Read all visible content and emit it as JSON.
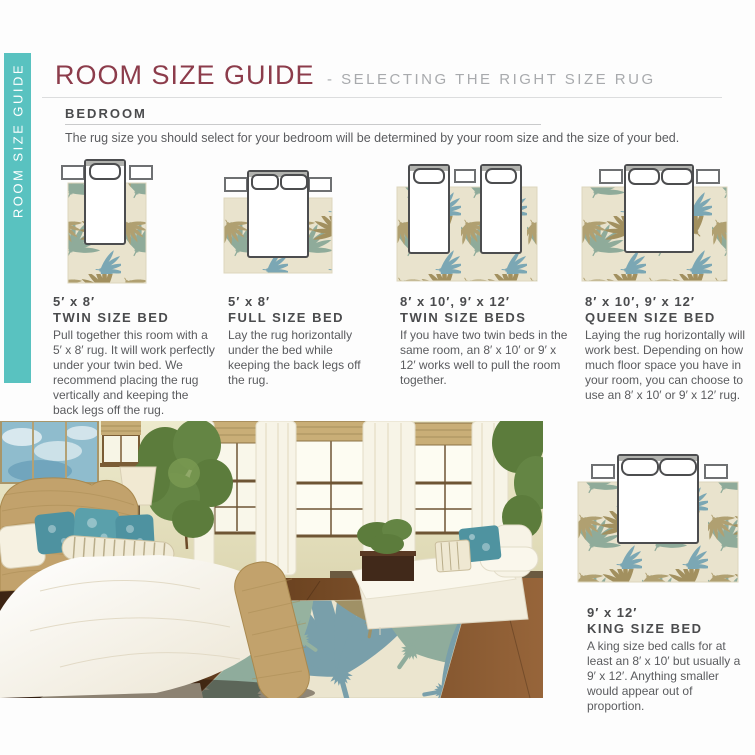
{
  "sidebar": {
    "label": "ROOM SIZE GUIDE"
  },
  "header": {
    "title": "ROOM SIZE GUIDE",
    "subtitle": "- SELECTING THE RIGHT SIZE RUG"
  },
  "section": {
    "heading": "BEDROOM",
    "intro": "The rug size you should select for your bedroom will be determined by your room size and the size of your bed."
  },
  "guides": [
    {
      "size": "5′ x 8′",
      "name": "TWIN SIZE BED",
      "description": "Pull together this room with a 5′ x 8′ rug. It will work perfectly under your twin bed. We recommend placing the rug vertically and keeping the back legs off the rug."
    },
    {
      "size": "5′ x 8′",
      "name": "FULL SIZE BED",
      "description": "Lay the rug horizontally under the bed while keeping the back legs off the rug."
    },
    {
      "size": "8′ x 10′, 9′ x 12′",
      "name": "TWIN SIZE BEDS",
      "description": "If you have two twin beds in the same room, an 8′ x 10′ or 9′ x 12′ works well to pull the room together."
    },
    {
      "size": "8′ x 10′, 9′ x 12′",
      "name": "QUEEN SIZE BED",
      "description": "Laying the rug horizontally will work best. Depending on how much floor space you have in your room, you can choose to use an 8′ x 10′ or 9′ x 12′ rug."
    },
    {
      "size": "9′ x 12′",
      "name": "KING SIZE BED",
      "description": "A king size bed calls for at least an 8′ x 10′ but usually a 9′ x 12′. Anything smaller would appear out of proportion."
    }
  ],
  "colors": {
    "accent_teal": "#59c2c0",
    "title_maroon": "#8c3c4b",
    "subtitle_gray": "#a8aaad",
    "text_gray": "#5a5b5e",
    "rug_cream": "#e9e3cd",
    "leaf_blue": "#7ba7b4",
    "leaf_olive": "#a2905f",
    "leaf_sage": "#8fab9a"
  }
}
